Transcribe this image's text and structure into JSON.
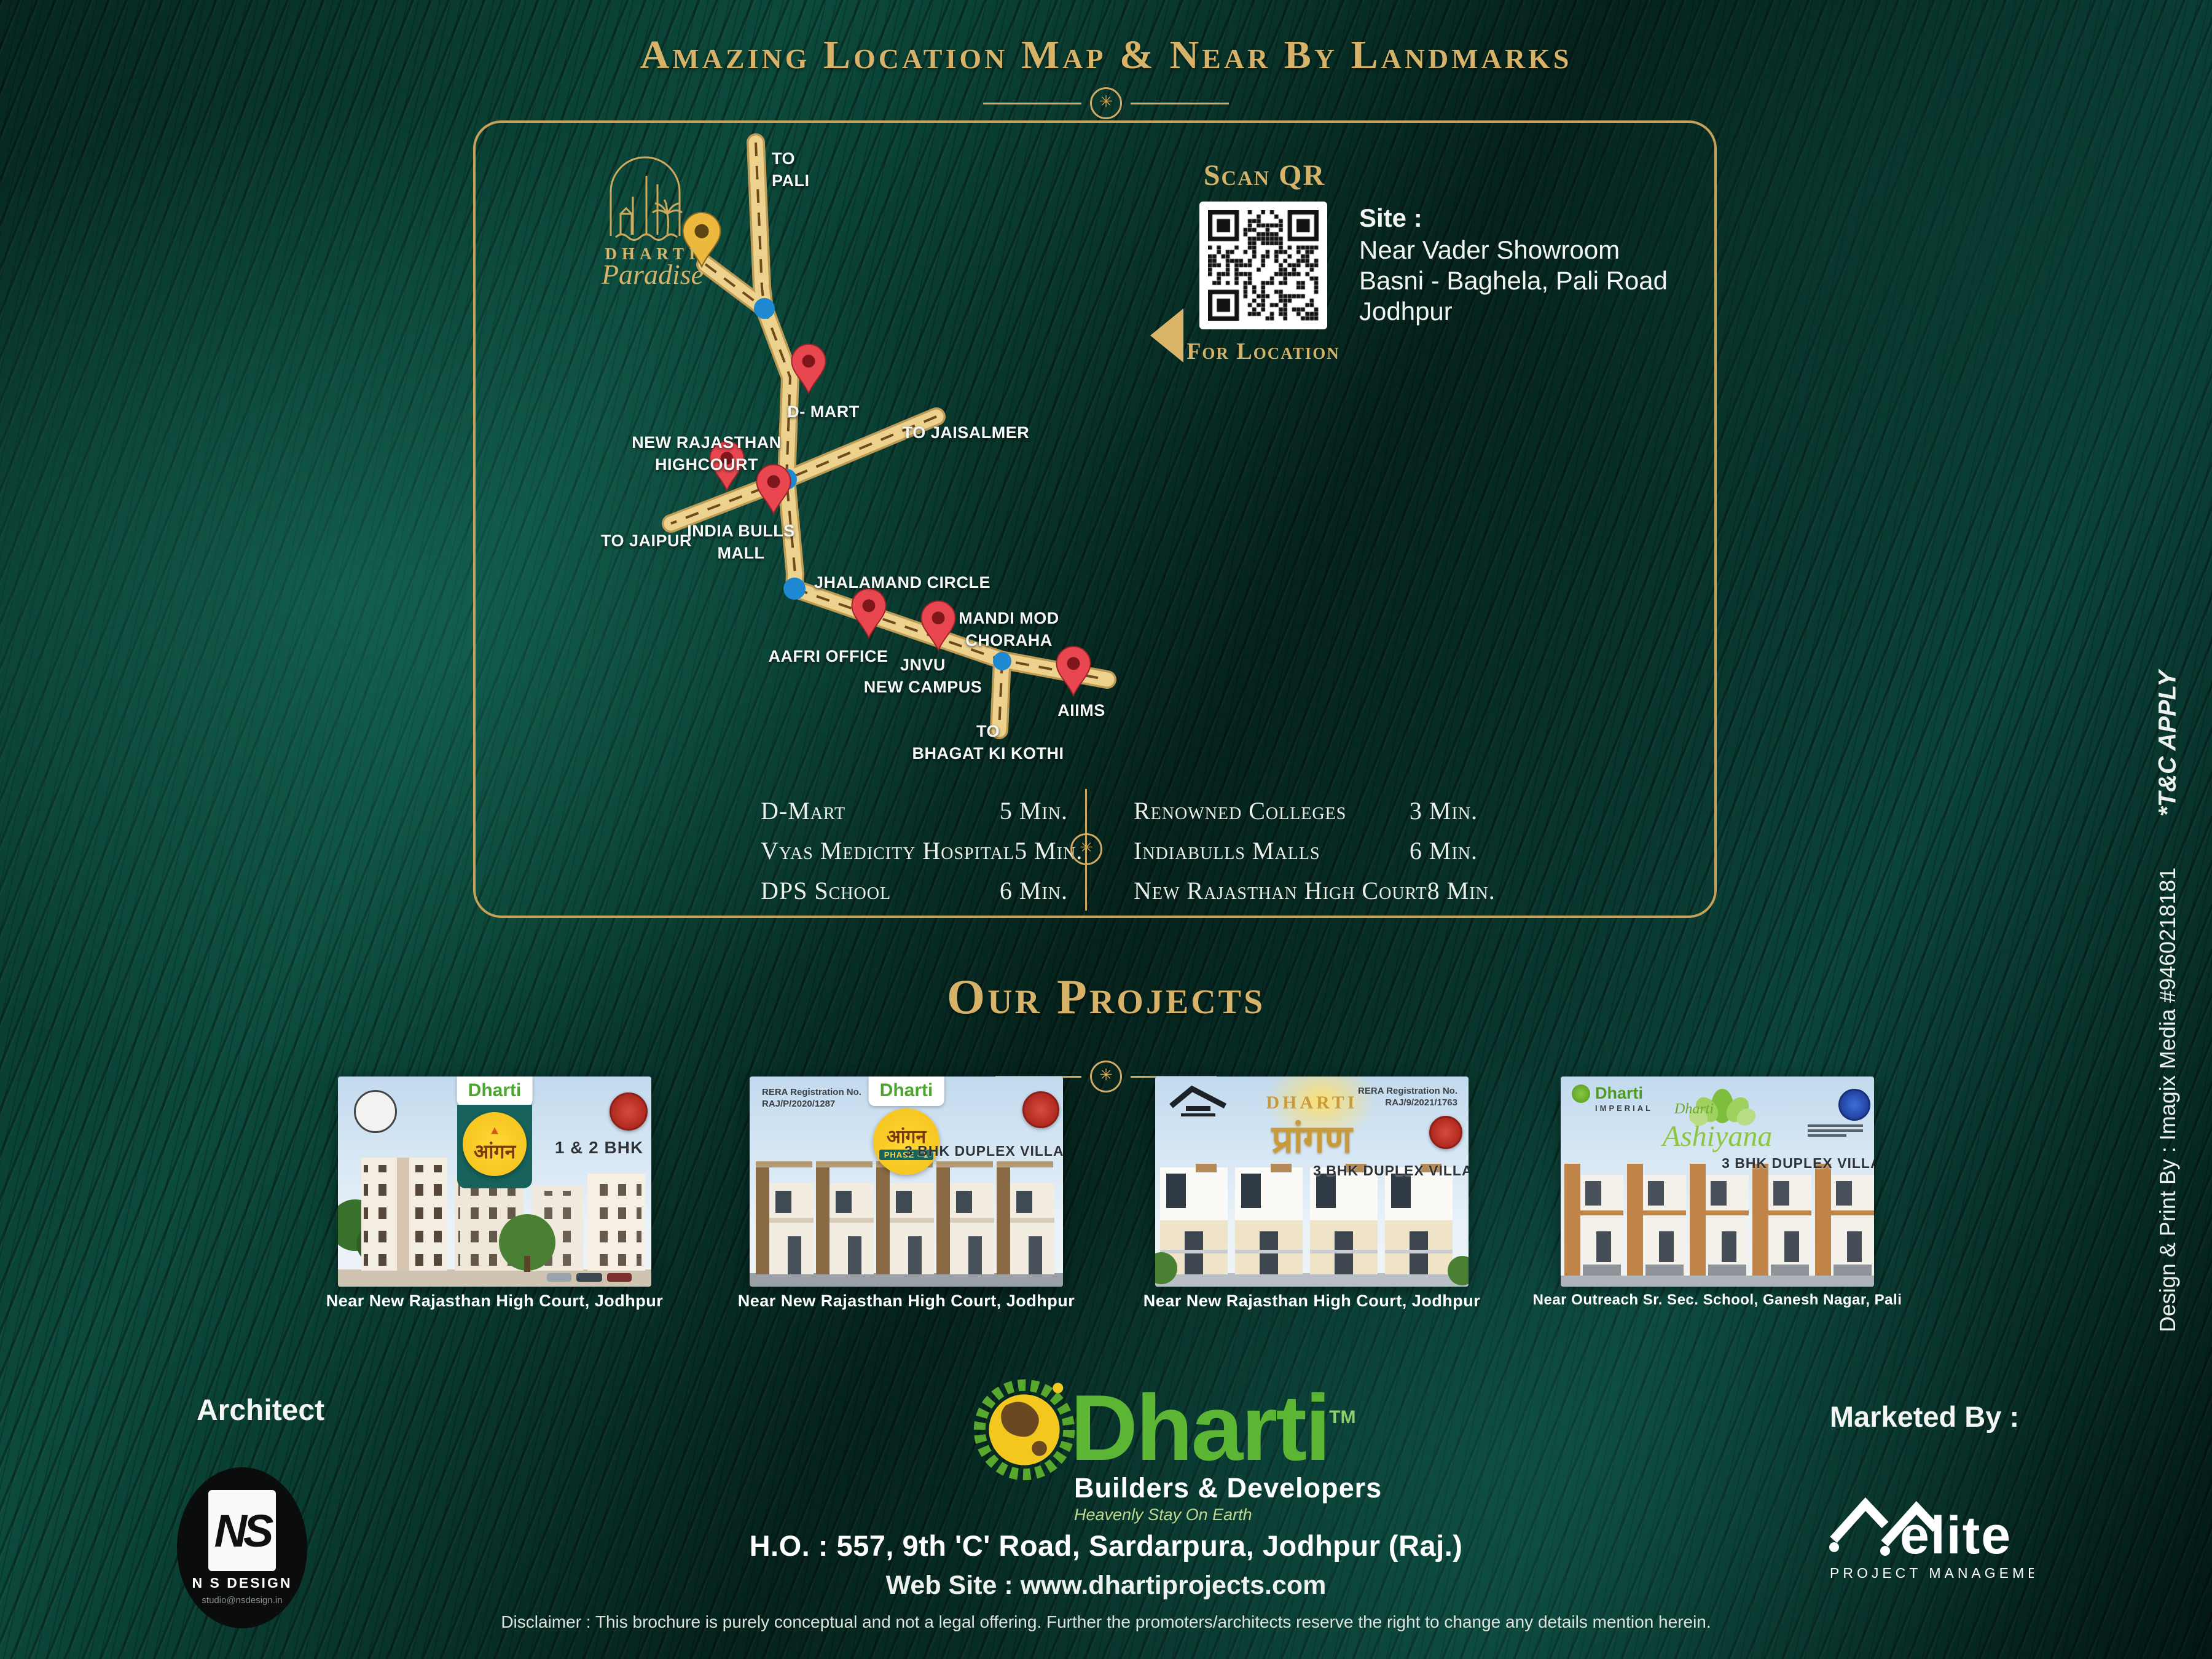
{
  "header": {
    "title": "Amazing Location Map & Near By Landmarks"
  },
  "map": {
    "logo": {
      "brand": "DHARTI",
      "name": "Paradise"
    },
    "labels": {
      "to_pali": [
        "TO",
        "PALI"
      ],
      "d_mart": "D- MART",
      "to_jaisalmer": "TO JAISALMER",
      "highcourt": [
        "NEW RAJASTHAN",
        "HIGHCOURT"
      ],
      "to_jaipur": "TO JAIPUR",
      "india_bulls": [
        "INDIA BULLS",
        "MALL"
      ],
      "jhalamand": "JHALAMAND CIRCLE",
      "mandi_mod": [
        "MANDI MOD",
        "CHORAHA"
      ],
      "aafri": "AAFRI OFFICE",
      "jnvu": [
        "JNVU",
        "NEW CAMPUS"
      ],
      "aiims": "AIIMS",
      "bhagat": [
        "TO",
        "BHAGAT KI KOTHI"
      ]
    },
    "qr": {
      "title": "Scan QR",
      "subtitle": "For Location"
    },
    "site": {
      "heading": "Site :",
      "lines": [
        "Near Vader Showroom",
        "Basni - Baghela, Pali Road",
        "Jodhpur"
      ]
    },
    "landmarks": {
      "left": [
        {
          "name": "D-Mart",
          "time": "5 Min."
        },
        {
          "name": "Vyas Medicity Hospital",
          "time": "5 Min."
        },
        {
          "name": "DPS School",
          "time": "6 Min."
        }
      ],
      "right": [
        {
          "name": "Renowned Colleges",
          "time": "3 Min."
        },
        {
          "name": "Indiabulls Malls",
          "time": "6 Min."
        },
        {
          "name": "New Rajasthan High Court",
          "time": "8 Min."
        }
      ]
    }
  },
  "projects": {
    "heading": "Our Projects",
    "cards": [
      {
        "brand": "Dharti",
        "badge": "आंगन",
        "type": "1 & 2 BHK",
        "caption": "Near New Rajasthan High Court, Jodhpur"
      },
      {
        "brand": "Dharti",
        "badge": "आंगन",
        "phase": "PHASE - 1",
        "reg1": "RERA Registration No.",
        "reg2": "RAJ/P/2020/1287",
        "type": "3 BHK DUPLEX VILLAS",
        "caption": "Near New Rajasthan High Court, Jodhpur"
      },
      {
        "brand": "DHARTI",
        "badge": "प्रांगण",
        "reg1": "RERA Registration No.",
        "reg2": "RAJ/9/2021/1763",
        "type": "3 BHK DUPLEX VILLAS",
        "caption": "Near New Rajasthan High Court, Jodhpur"
      },
      {
        "brand_top": "Dharti",
        "brand_top_sub": "IMPERIAL",
        "brand": "Dharti",
        "name": "Ashiyana",
        "type": "3 BHK DUPLEX VILLAS",
        "caption": "Near Outreach Sr. Sec. School, Ganesh Nagar, Pali"
      }
    ]
  },
  "footer": {
    "architect_label": "Architect",
    "ns": {
      "monogram": "NS",
      "name": "N S DESIGN",
      "email": "studio@nsdesign.in"
    },
    "dharti": {
      "name": "Dharti",
      "tm": "TM",
      "sub": "Builders & Developers",
      "tagline": "Heavenly Stay On Earth"
    },
    "address": "H.O. : 557, 9th 'C' Road, Sardarpura, Jodhpur (Raj.)",
    "website": "Web Site : www.dhartiprojects.com",
    "marketed_label": "Marketed By :",
    "elite": {
      "name": "elite",
      "sub": "PROJECT MANAGEMENT"
    },
    "disclaimer": "Disclaimer : This brochure is purely conceptual and not a legal offering. Further the promoters/architects reserve the right to change any details mention herein."
  },
  "side": {
    "tc": "*T&C APPLY",
    "credit": "Design & Print By : Imagix Media #9460218181"
  },
  "colors": {
    "gold": "#d2ab62",
    "teal_bg": "#0a4238",
    "road": "#ecd28d",
    "pin_red": "#e8474f",
    "dot_blue": "#1e88d2",
    "dharti_green": "#5db633"
  }
}
